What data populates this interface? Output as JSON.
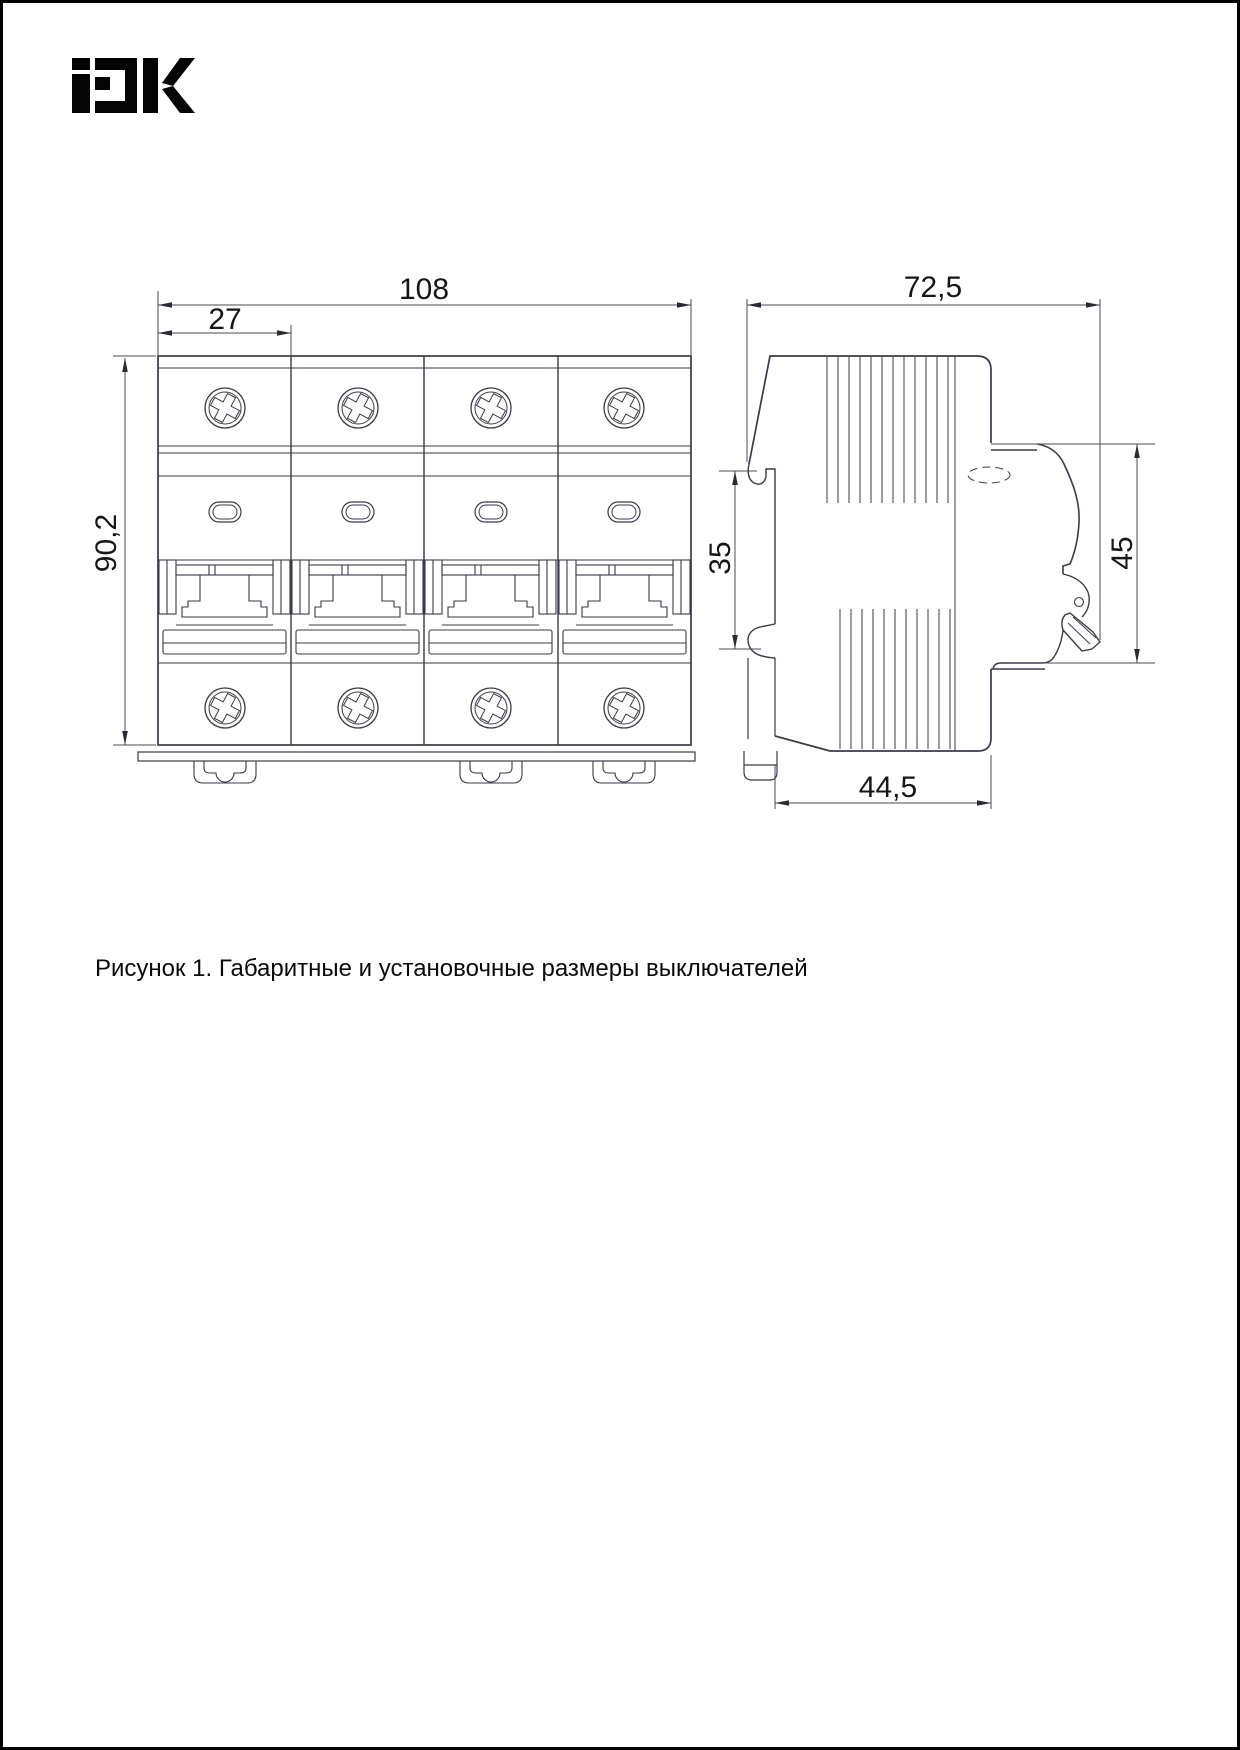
{
  "page": {
    "background": "#ffffff",
    "border_color": "#000000"
  },
  "brand": {
    "logo_alt": "iEK",
    "logo_color": "#050505"
  },
  "drawing": {
    "line_color": "#3a3a4a",
    "dimension_text_color": "#161616",
    "front_view": {
      "dims": {
        "width": "108",
        "module_width": "27",
        "height": "90,2"
      }
    },
    "side_view": {
      "dims": {
        "depth": "72,5",
        "rail_slot": "35",
        "front_height": "45",
        "mount_depth": "44,5"
      }
    }
  },
  "caption": {
    "text": "Рисунок 1. Габаритные и установочные размеры выключателей"
  }
}
